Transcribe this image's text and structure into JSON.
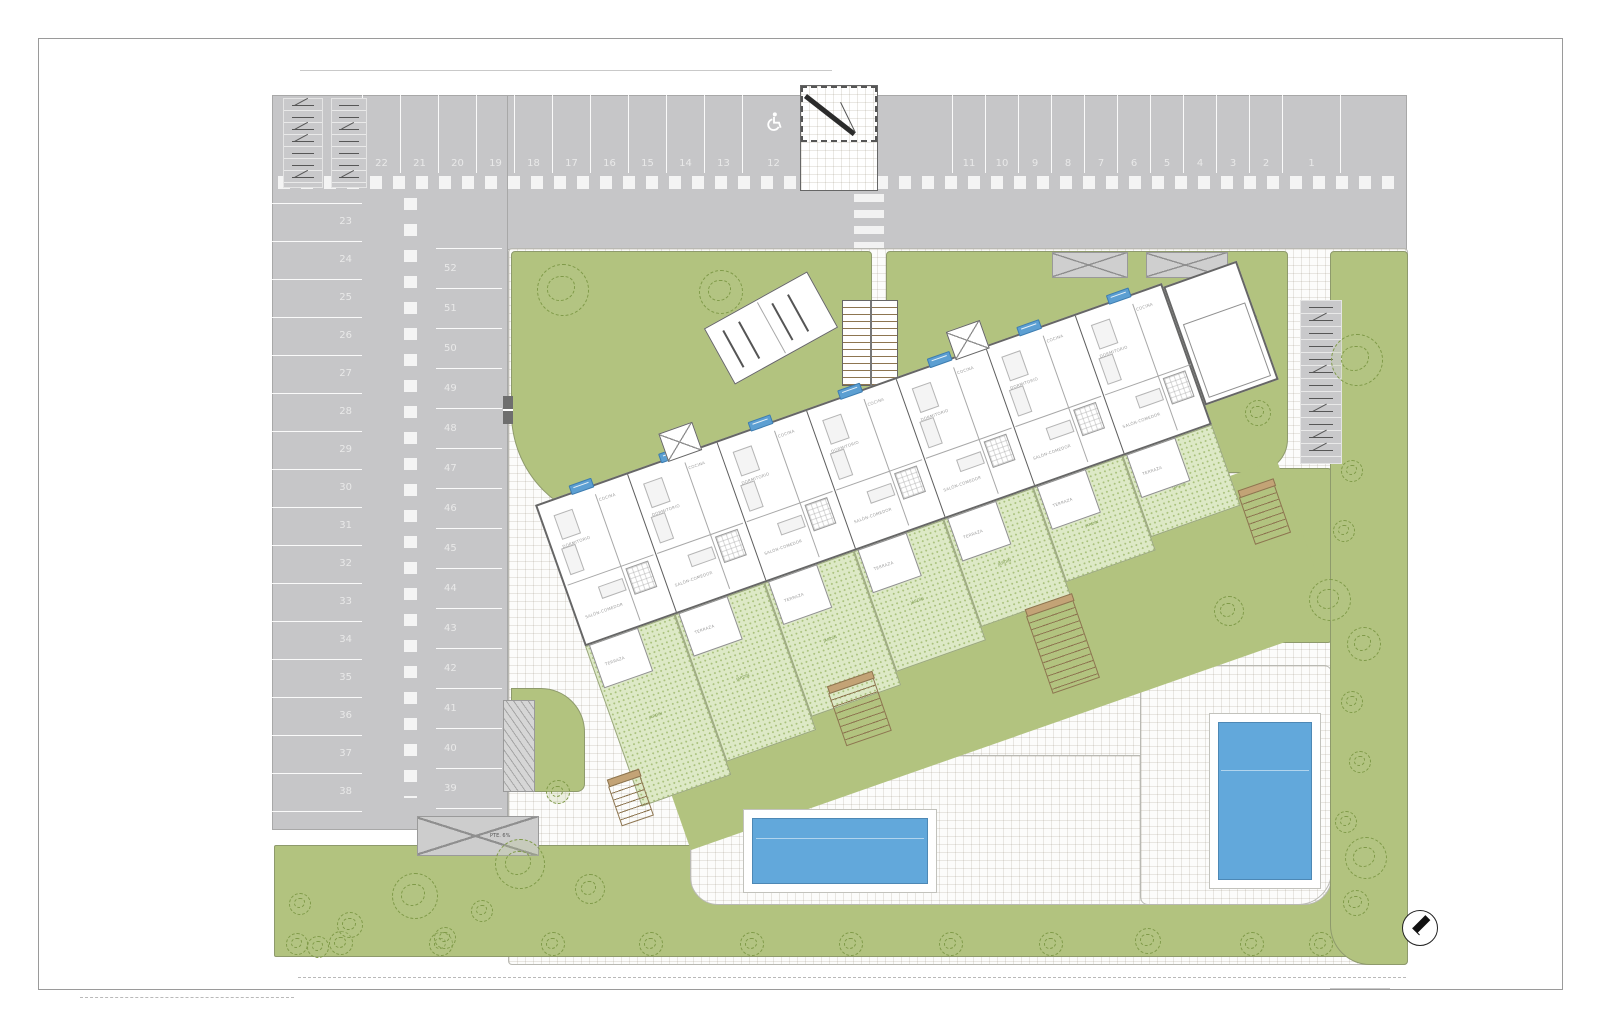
{
  "title": "site-plan-drawing",
  "colors": {
    "asphalt": "#c6c6c8",
    "lawn": "#b2c37f",
    "tree_line": "#7f9a48",
    "pool": "#62a8db",
    "tag_blue": "#5c9fd2",
    "stair_tan": "#c3a376",
    "terrace_stipple": "#dde9c6",
    "stipple_dot": "#a9c17c",
    "number_text": "#e9e9e9"
  },
  "parking": {
    "top_left_row": [
      "22",
      "21",
      "20",
      "19",
      "18",
      "17",
      "16",
      "15",
      "14",
      "13",
      "12"
    ],
    "top_right_row": [
      "11",
      "10",
      "9",
      "8",
      "7",
      "6",
      "5",
      "4",
      "3",
      "2",
      "1"
    ],
    "left_column": [
      "23",
      "24",
      "25",
      "26",
      "27",
      "28",
      "29",
      "30",
      "31",
      "32",
      "33",
      "34",
      "35",
      "36",
      "37",
      "38"
    ],
    "middle_column": [
      "52",
      "51",
      "50",
      "49",
      "48",
      "47",
      "46",
      "45",
      "44",
      "43",
      "42",
      "41",
      "40",
      "39"
    ],
    "handicap_space": "12",
    "bike_rack_left_slots": 7,
    "bike_rack_left2_slots": 7,
    "bike_rack_right_slots": 12
  },
  "labels": {
    "ramp": "PTE. 6%",
    "terrace": "TERRAZA",
    "garden": "JARDÍN",
    "room_bedroom": "DORMITORIO",
    "room_living": "SALÓN-COMEDOR",
    "room_kitchen": "COCINA"
  },
  "building": {
    "unit_count": 7,
    "unit_tag_count": 7,
    "has_storage_block": true,
    "has_stair_block": true,
    "rotation_deg": -19.5
  },
  "pools": [
    {
      "x": 752,
      "y": 818,
      "w": 176,
      "h": 66
    },
    {
      "x": 1218,
      "y": 722,
      "w": 94,
      "h": 158
    }
  ],
  "stairs": [
    {
      "x": 614,
      "y": 780,
      "w": 34,
      "h": 42
    },
    {
      "x": 836,
      "y": 684,
      "w": 48,
      "h": 56
    },
    {
      "x": 1038,
      "y": 606,
      "w": 50,
      "h": 82
    },
    {
      "x": 1246,
      "y": 490,
      "w": 38,
      "h": 50
    }
  ],
  "pergolas": [
    {
      "x": 1052,
      "y": 252,
      "w": 76,
      "h": 26
    },
    {
      "x": 1146,
      "y": 252,
      "w": 82,
      "h": 26
    }
  ],
  "compass": {
    "x": 1402,
    "y": 910,
    "d": 36
  },
  "trees": [
    [
      563,
      290,
      26
    ],
    [
      721,
      292,
      22
    ],
    [
      1232,
      327,
      27
    ],
    [
      1357,
      360,
      26
    ],
    [
      1258,
      413,
      13
    ],
    [
      1352,
      471,
      11
    ],
    [
      1344,
      531,
      11
    ],
    [
      1330,
      600,
      21
    ],
    [
      1229,
      611,
      15
    ],
    [
      1364,
      644,
      17
    ],
    [
      1352,
      702,
      11
    ],
    [
      1360,
      762,
      11
    ],
    [
      1346,
      822,
      11
    ],
    [
      1366,
      858,
      21
    ],
    [
      1356,
      903,
      13
    ],
    [
      297,
      944,
      11
    ],
    [
      318,
      947,
      11
    ],
    [
      341,
      943,
      12
    ],
    [
      441,
      944,
      12
    ],
    [
      553,
      944,
      12
    ],
    [
      651,
      944,
      12
    ],
    [
      752,
      944,
      12
    ],
    [
      851,
      944,
      12
    ],
    [
      951,
      944,
      12
    ],
    [
      1051,
      944,
      12
    ],
    [
      1148,
      941,
      13
    ],
    [
      1252,
      944,
      12
    ],
    [
      1321,
      944,
      12
    ],
    [
      415,
      896,
      23
    ],
    [
      520,
      864,
      25
    ],
    [
      590,
      889,
      15
    ],
    [
      482,
      911,
      11
    ],
    [
      445,
      938,
      11
    ],
    [
      350,
      925,
      13
    ],
    [
      300,
      904,
      11
    ],
    [
      558,
      792,
      12
    ]
  ]
}
